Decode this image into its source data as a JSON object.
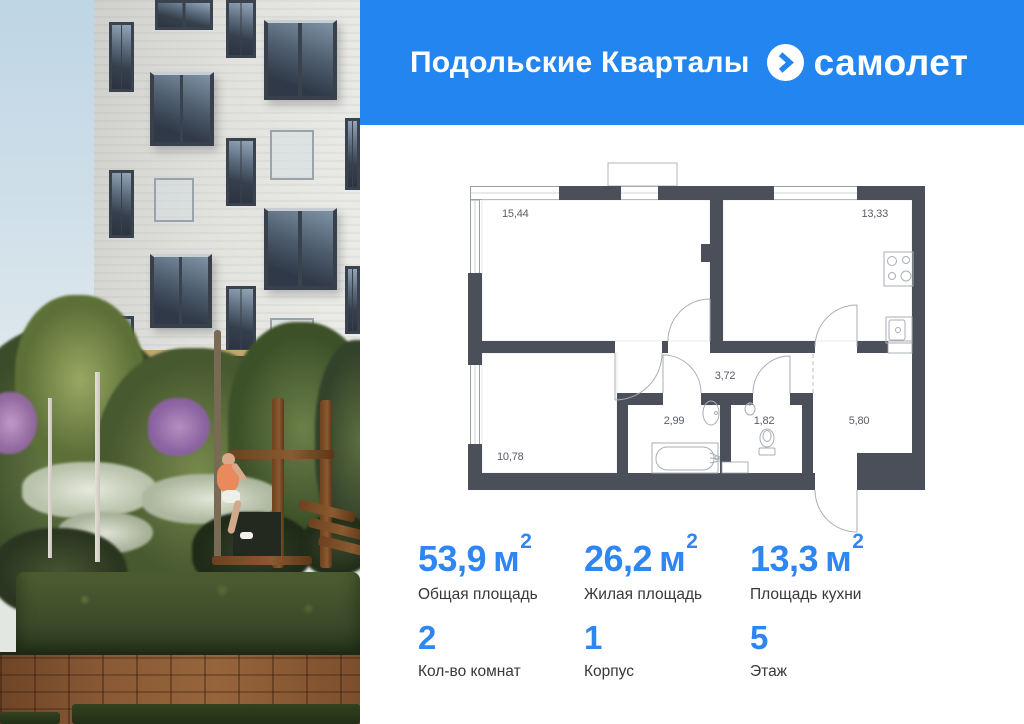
{
  "header": {
    "project_name": "Подольские Кварталы",
    "brand_name": "самолет"
  },
  "floor_plan": {
    "rooms": [
      {
        "name": "living-room",
        "area": "15,44"
      },
      {
        "name": "kitchen",
        "area": "13,33"
      },
      {
        "name": "hallway",
        "area": "3,72"
      },
      {
        "name": "bathroom",
        "area": "2,99"
      },
      {
        "name": "wc",
        "area": "1,82"
      },
      {
        "name": "entrance-hall",
        "area": "5,80"
      },
      {
        "name": "bedroom",
        "area": "10,78"
      }
    ]
  },
  "stats": {
    "row1": [
      {
        "value": "53,9",
        "unit": "м",
        "sup": "2",
        "label": "Общая площадь"
      },
      {
        "value": "26,2",
        "unit": "м",
        "sup": "2",
        "label": "Жилая площадь"
      },
      {
        "value": "13,3",
        "unit": "м",
        "sup": "2",
        "label": "Площадь кухни"
      }
    ],
    "row2": [
      {
        "value": "2",
        "label": "Кол-во комнат"
      },
      {
        "value": "1",
        "label": "Корпус"
      },
      {
        "value": "5",
        "label": "Этаж"
      }
    ]
  },
  "colors": {
    "header_bg": "#2386f0",
    "accent": "#2e86f2",
    "plan_wall": "#4b4f5a"
  }
}
